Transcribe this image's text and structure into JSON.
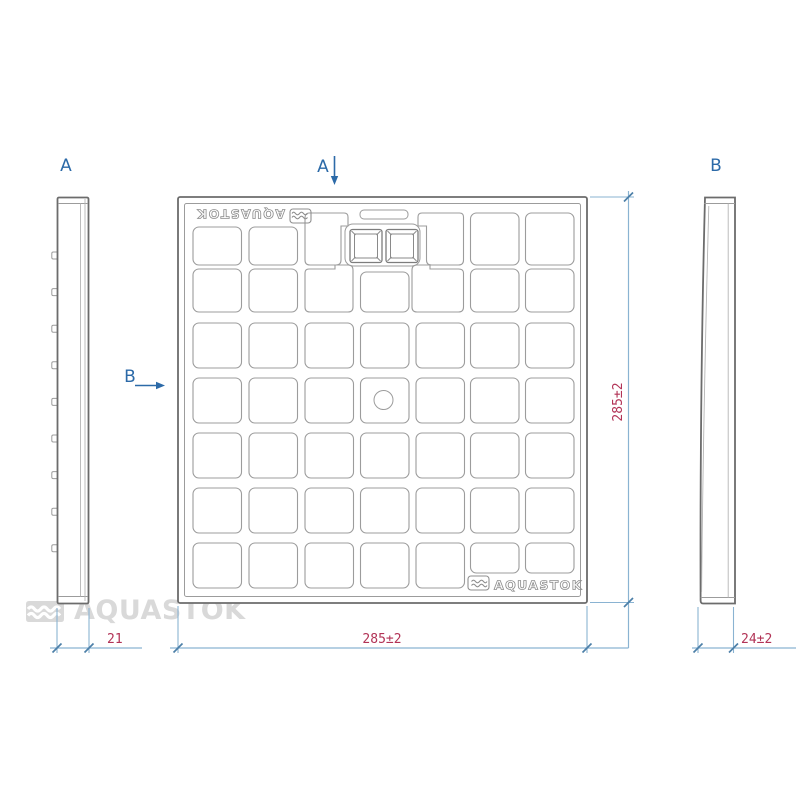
{
  "views": {
    "section_a_label": "A",
    "section_b_label": "B"
  },
  "dimensions": {
    "plate_width": "285±2",
    "plate_height": "285±2",
    "side_a_thickness": "21",
    "side_b_thickness": "24±2"
  },
  "branding": {
    "logo_text": "AQUASTOK",
    "watermark_text": "AQUASTOK"
  },
  "grid": {
    "rows": 7,
    "cols": 7,
    "pattern": "rounded-squares",
    "center_hole": true
  },
  "colors": {
    "dim_text": "#b23356",
    "dim_line": "#8ab3d2",
    "dim_tick": "#4c7fa8",
    "label": "#2c6aa8",
    "line": "#9c9c9c",
    "frame": "#6c6c6c",
    "watermark": "#d9d9d9",
    "logo": "#8f8f8f"
  }
}
